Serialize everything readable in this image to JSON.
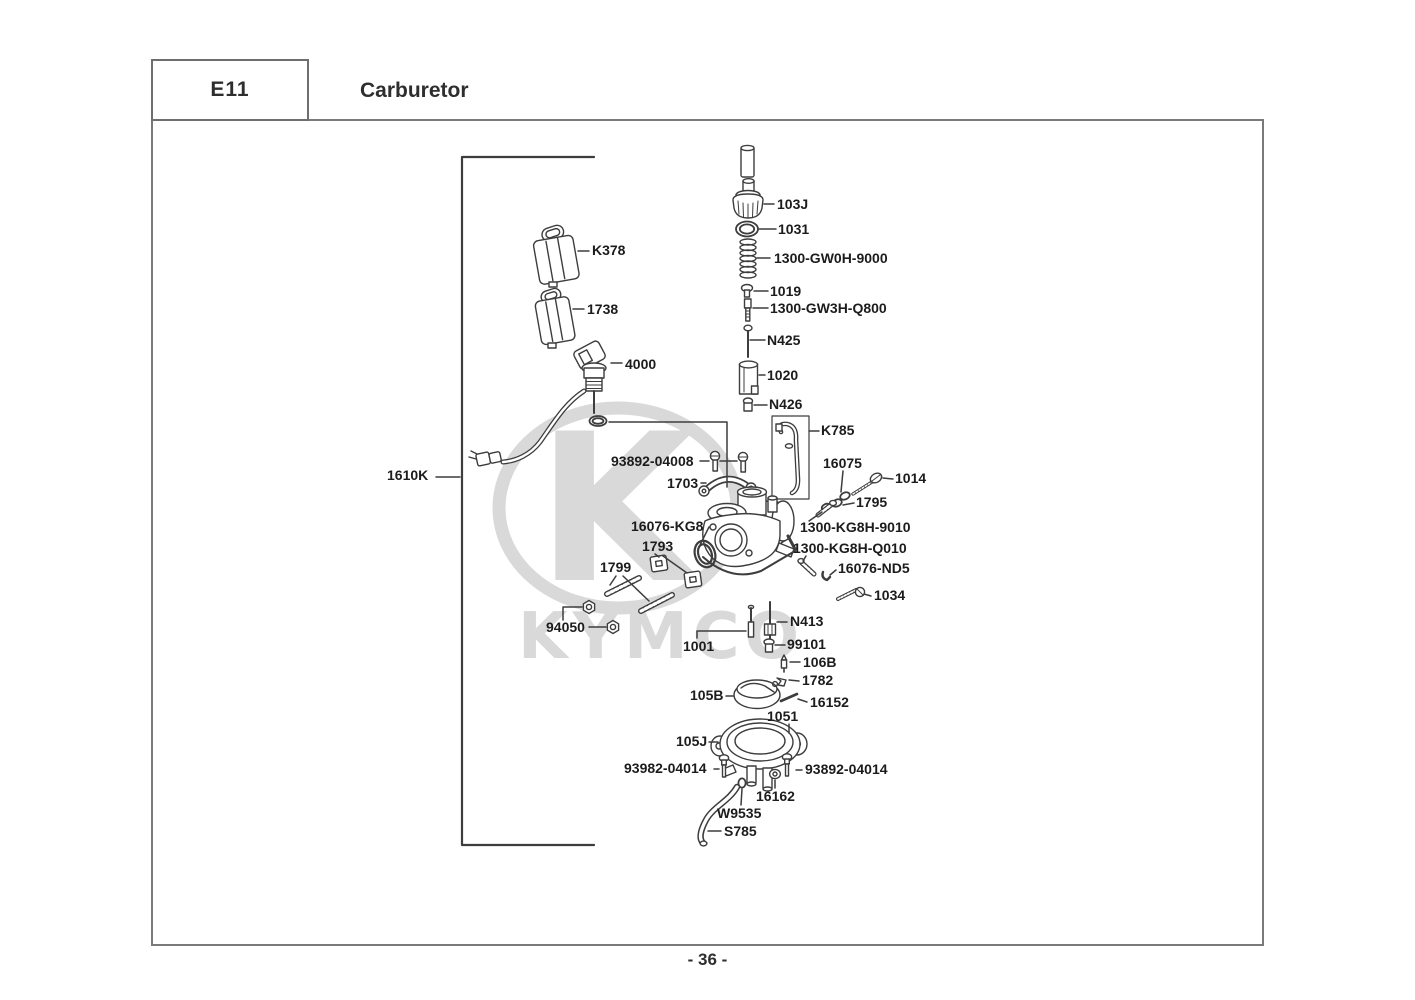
{
  "header": {
    "code": "E11",
    "title": "Carburetor"
  },
  "footer": {
    "page_number": "- 36 -"
  },
  "watermark": {
    "logo_letter": "K",
    "brand": "KYMCO"
  },
  "diagram": {
    "labels": {
      "k378": "K378",
      "c1738": "1738",
      "m4000": "4000",
      "g1610k": "1610K",
      "j103": "103J",
      "o1031": "1031",
      "gw0h": "1300-GW0H-9000",
      "s1019": "1019",
      "gw3h": "1300-GW3H-Q800",
      "n425": "N425",
      "v1020": "1020",
      "n426": "N426",
      "k785": "K785",
      "b04008": "93892-04008",
      "b1703": "1703",
      "w16075": "16075",
      "s1014": "1014",
      "w1795": "1795",
      "okg8": "16076-KG8",
      "s9010": "1300-KG8H-9010",
      "c1793": "1793",
      "sq010": "1300-KG8H-Q010",
      "st1799": "1799",
      "pnd5": "16076-ND5",
      "s1034": "1034",
      "n94050": "94050",
      "n413": "N413",
      "n1001": "1001",
      "j99101": "99101",
      "v106b": "106B",
      "c1782": "1782",
      "f105b": "105B",
      "p16152": "16152",
      "g1051": "1051",
      "b105j": "105J",
      "b93982": "93982-04014",
      "b93892": "93892-04014",
      "n16162": "16162",
      "ow9535": "W9535",
      "ts785": "S785"
    }
  }
}
